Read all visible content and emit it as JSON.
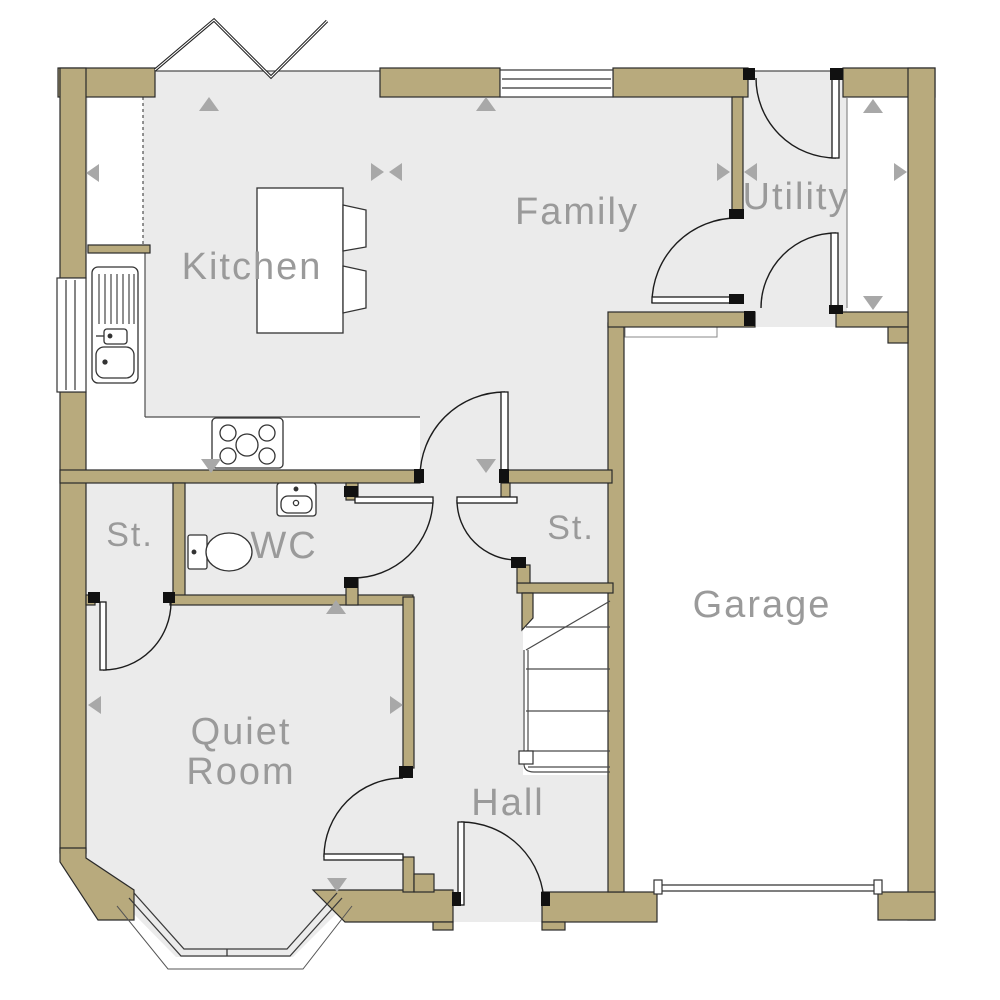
{
  "plan_title": "house-ground-floor-plan",
  "colors": {
    "wall_fill": "#b8aa7d",
    "wall_outline": "#2a2a2a",
    "floor_fill": "#ebebeb",
    "thin_line": "#4d4d4d",
    "door_line": "#1c1c1c",
    "label_text": "#9a9a9a",
    "arrow_fill": "#a8a8a8",
    "fixture_fill": "#ffffff"
  },
  "rooms": [
    {
      "id": "kitchen",
      "label": "Kitchen",
      "x": 252,
      "y": 268,
      "font_size": 38
    },
    {
      "id": "family",
      "label": "Family",
      "x": 577,
      "y": 213,
      "font_size": 38
    },
    {
      "id": "utility",
      "label": "Utility",
      "x": 796,
      "y": 198,
      "font_size": 38
    },
    {
      "id": "garage",
      "label": "Garage",
      "x": 762,
      "y": 606,
      "font_size": 38
    },
    {
      "id": "quiet-room",
      "label": "Quiet\nRoom",
      "x": 241,
      "y": 753,
      "font_size": 38
    },
    {
      "id": "hall",
      "label": "Hall",
      "x": 508,
      "y": 804,
      "font_size": 38
    },
    {
      "id": "wc",
      "label": "WC",
      "x": 284,
      "y": 547,
      "font_size": 38
    },
    {
      "id": "storage-left",
      "label": "St.",
      "x": 130,
      "y": 536,
      "font_size": 34
    },
    {
      "id": "storage-right",
      "label": "St.",
      "x": 571,
      "y": 529,
      "font_size": 34
    }
  ],
  "arrows": [
    {
      "x": 199,
      "y": 97,
      "dir": "up"
    },
    {
      "x": 86,
      "y": 164,
      "dir": "left"
    },
    {
      "x": 371,
      "y": 163,
      "dir": "right"
    },
    {
      "x": 389,
      "y": 163,
      "dir": "left"
    },
    {
      "x": 476,
      "y": 97,
      "dir": "up"
    },
    {
      "x": 717,
      "y": 163,
      "dir": "right"
    },
    {
      "x": 744,
      "y": 163,
      "dir": "left"
    },
    {
      "x": 863,
      "y": 99,
      "dir": "up"
    },
    {
      "x": 863,
      "y": 296,
      "dir": "down"
    },
    {
      "x": 894,
      "y": 163,
      "dir": "right"
    },
    {
      "x": 201,
      "y": 459,
      "dir": "down"
    },
    {
      "x": 476,
      "y": 459,
      "dir": "down"
    },
    {
      "x": 326,
      "y": 600,
      "dir": "up"
    },
    {
      "x": 88,
      "y": 696,
      "dir": "left"
    },
    {
      "x": 390,
      "y": 696,
      "dir": "right"
    },
    {
      "x": 327,
      "y": 878,
      "dir": "down"
    }
  ],
  "fixtures": [
    "bi-fold-doors",
    "rear-window",
    "side-window",
    "kitchen-island",
    "bar-stools",
    "sink-drainer-unit",
    "hob",
    "toilet",
    "wash-basin",
    "staircase",
    "bay-window",
    "front-door",
    "garage-door",
    "internal-doors"
  ]
}
